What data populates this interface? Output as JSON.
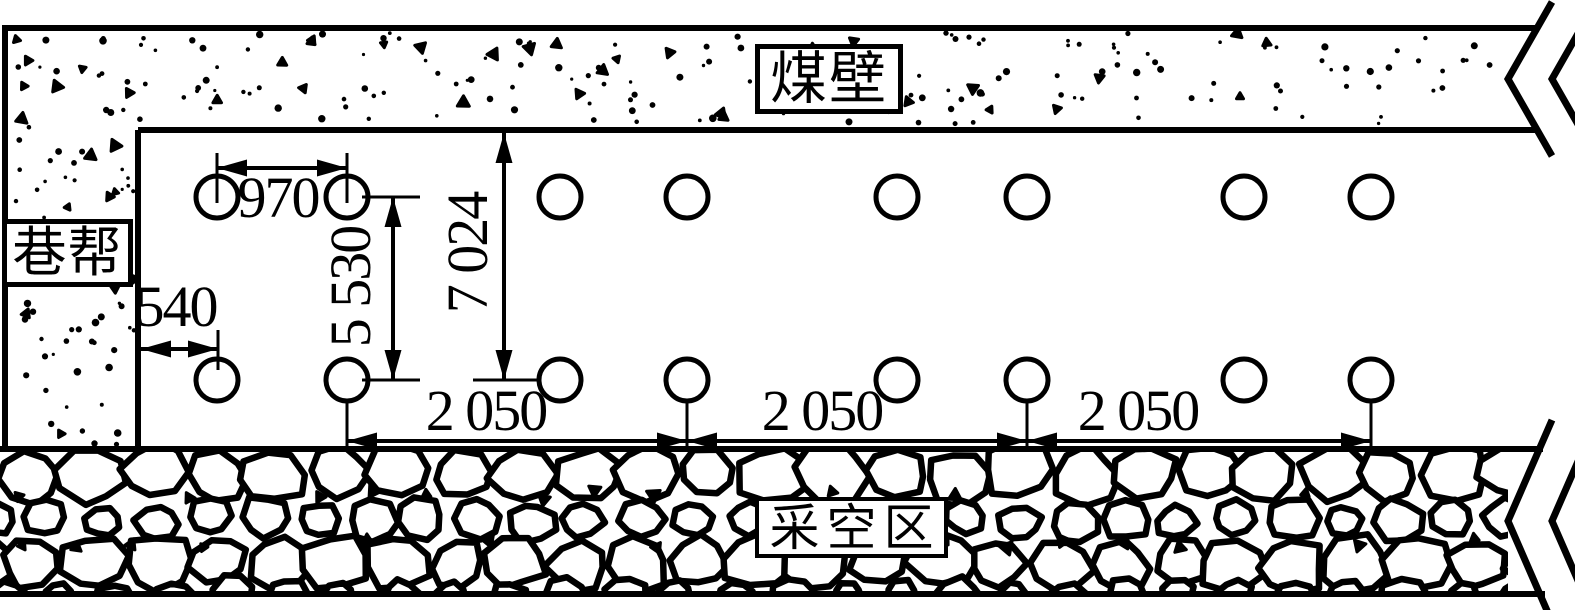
{
  "labels": {
    "coal_wall": "煤壁",
    "roadway_rib": "巷帮",
    "goaf": "采空区"
  },
  "dimensions": {
    "pair_hole_spacing": "970",
    "rib_to_first_hole": "540",
    "row_spacing": "5 530",
    "coal_wall_to_lower_row": "7 024",
    "group_spacing": [
      "2 050",
      "2 050",
      "2 050"
    ]
  },
  "boreholes": {
    "rows": 2,
    "holes_per_row": 8,
    "pairs_per_row": 4
  },
  "colors": {
    "ink": "#000000",
    "paper": "#ffffff"
  }
}
